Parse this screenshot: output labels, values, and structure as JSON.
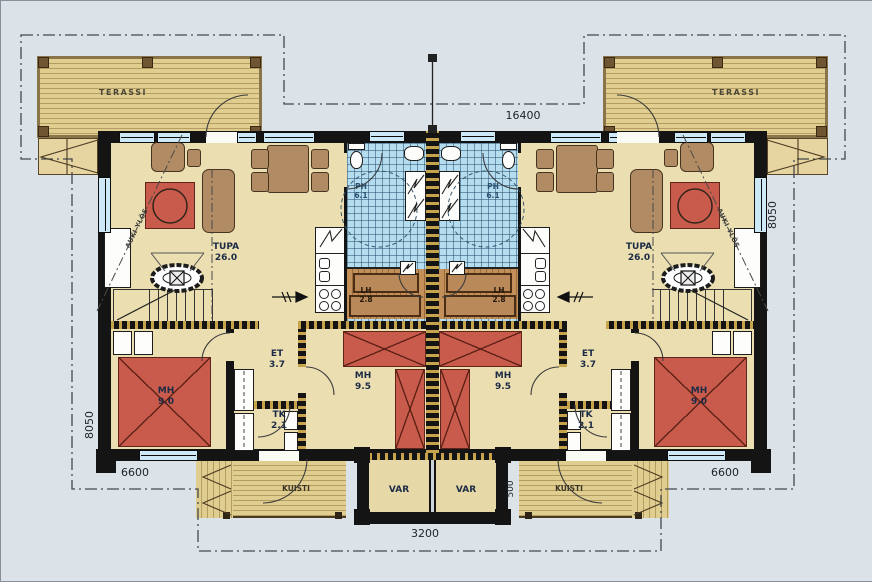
{
  "labels": {
    "terassi": "TERASSI",
    "kuisti": "KUISTI",
    "var": "VAR",
    "auki_ylos": "AUKI YLÖS"
  },
  "rooms": {
    "tupa": {
      "name": "TUPA",
      "area": "26.0"
    },
    "ph": {
      "name": "PH",
      "area": "6.1"
    },
    "lh": {
      "name": "LH",
      "area": "2.8"
    },
    "et": {
      "name": "ET",
      "area": "3.7"
    },
    "tk": {
      "name": "TK",
      "area": "2.1"
    },
    "mh_large": {
      "name": "MH",
      "area": "9.5"
    },
    "mh_small": {
      "name": "MH",
      "area": "9.0"
    }
  },
  "dimensions": {
    "overall_width": "16400",
    "left_height": "8050",
    "right_height": "8050",
    "unit_width_left": "6600",
    "unit_width_right": "6600",
    "porch_width": "3200",
    "porch_depth": "500"
  },
  "colors": {
    "background": "#dbe2e8",
    "floor": "#ebdfb2",
    "terrace_wood": "#dcc98c",
    "tile_blue": "#b5ddf0",
    "accent_red": "#c95b4d",
    "wall_black": "#141414",
    "log_hatch_gold": "#c7a44b",
    "furniture_brown": "#b08b63"
  }
}
